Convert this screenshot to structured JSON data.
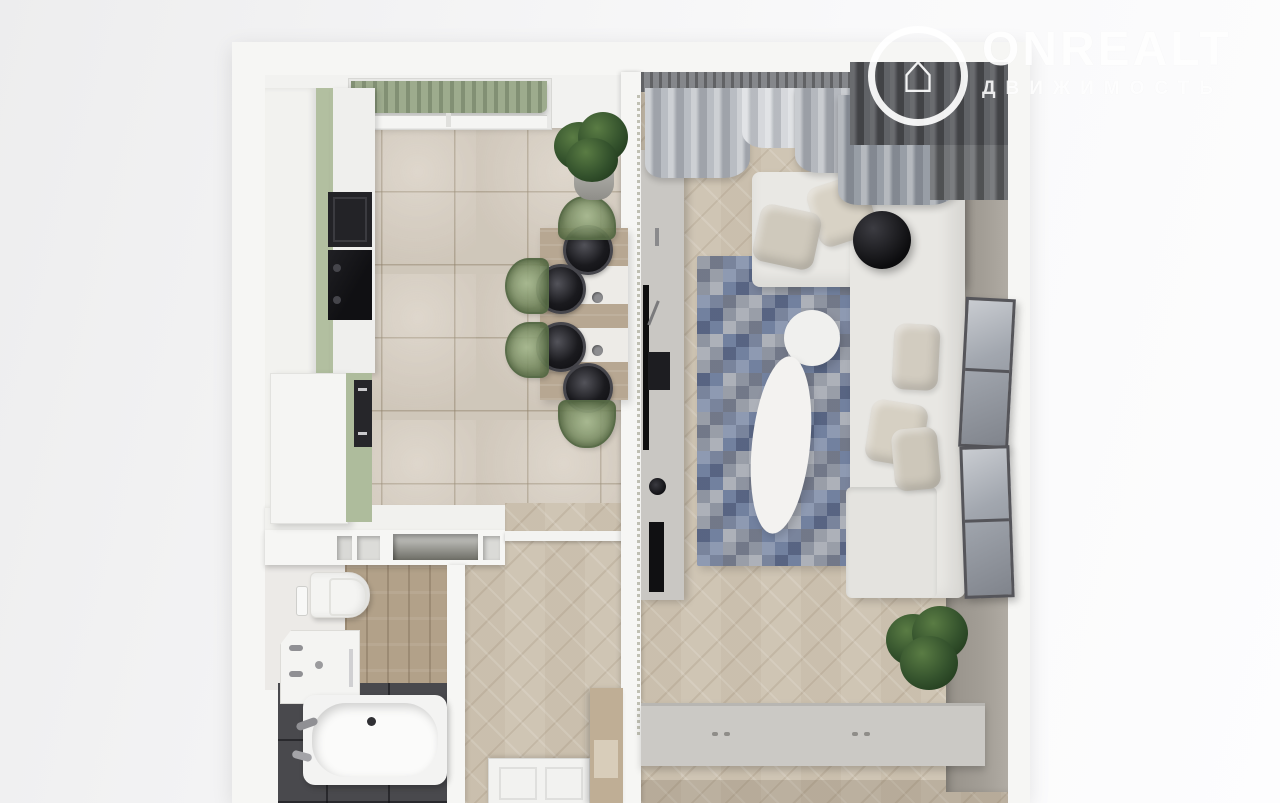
{
  "watermark": {
    "brand": "ONREALT",
    "subtitle": "ДВИЖИМОСТЬ",
    "icon": "house-icon"
  },
  "scene": {
    "description": "3D top-down rendered floor plan of a one-room apartment",
    "rooms": [
      "kitchen",
      "living-room",
      "bathroom",
      "hallway"
    ]
  },
  "colors": {
    "bg_left": "#ededee",
    "bg_right": "#fdfdfe",
    "wall": "#f6f6f4",
    "kitchen_tile": "#d7cec1",
    "cabinet_green": "#b2bfa0",
    "cabinet_white": "#f2f2ef",
    "appliance_dark": "#1d1d21",
    "table_wood": "#b7a792",
    "chair_green": "#7f9468",
    "wood_floor": "#cfc5b4",
    "rug_blue": "#72819f",
    "sofa": "#e9e8e4",
    "pillow_beige": "#d8d2c5",
    "curtain_light": "#b5b9bf",
    "curtain_gray": "#9298a0",
    "curtain_dark": "#5b5d61",
    "console_gray": "#c9c7c3",
    "wall_gray": "#a39e96",
    "wardrobe_gray": "#cbc9c5",
    "bath_tile_dark": "#49494d",
    "bath_wood": "#b2a189",
    "fixture_white": "#f4f4f2",
    "chrome": "#909094",
    "plant_green": "#33512c",
    "shade_green": "#9dab8d"
  }
}
